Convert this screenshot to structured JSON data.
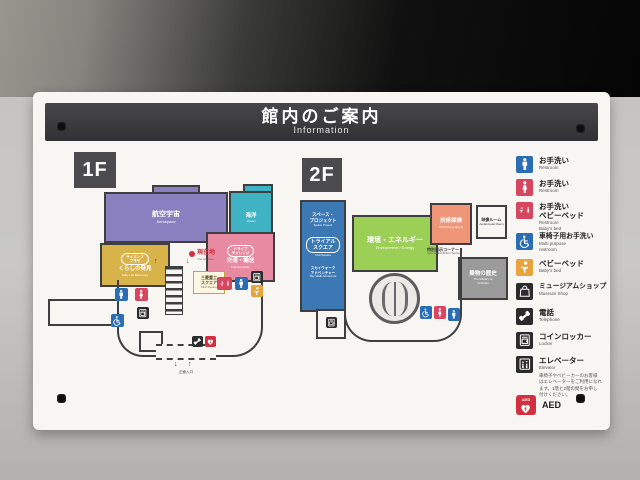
{
  "header": {
    "title_jp": "館内のご案内",
    "title_en": "Information"
  },
  "floor1": {
    "label": "1F",
    "rooms": {
      "aerospace": {
        "jp": "航空宇宙",
        "en": "Aerospace"
      },
      "ocean": {
        "jp": "海洋",
        "en": "Ocean"
      },
      "daily": {
        "badge1": "サイエンス",
        "badge2": "プラザ",
        "jp": "くらしの発見",
        "en": "Daily Life Discovery"
      },
      "transport": {
        "badge1": "ドライブ",
        "badge2": "チャレンジ",
        "jp": "交通・輸送",
        "en": "Transportation"
      }
    },
    "marker_jp": "現在地",
    "marker_en": "You are here",
    "mhi1": "三菱重工",
    "mhi2": "スクエア",
    "mhi_en": "MHI Square",
    "entrance": "正面入口",
    "arrow_down": "↓",
    "arrow_up": "↑",
    "stair_up": "↑",
    "stair_down": "↓"
  },
  "floor2": {
    "label": "2F",
    "rooms": {
      "space": {
        "jp1": "スペース・",
        "jp2": "プロジェクト",
        "en": "Space Project"
      },
      "trial": {
        "b1": "トライアル",
        "b2": "スクエア",
        "en": "Trial Square"
      },
      "skywalk": {
        "jp1": "スカイウォーク",
        "jp2": "アドベンチャー",
        "en": "Sky Walk Adventure"
      },
      "environment": {
        "jp": "環境・エネルギー",
        "en": "Environment / Energy"
      },
      "technology": {
        "jp": "技術探検",
        "en": "Technology Quest"
      },
      "av_room": {
        "jp": "映像ルーム",
        "en": "Audiovisual Room"
      },
      "special": {
        "jp": "特別展示コーナー",
        "en": "Special Exhibition Section"
      },
      "history": {
        "jp": "乗物の歴史",
        "en1": "The History of",
        "en2": "Vehicles"
      }
    }
  },
  "legend": {
    "items": [
      {
        "jp": "お手洗い",
        "en": "Restroom"
      },
      {
        "jp": "お手洗い",
        "en": "Restroom"
      },
      {
        "jp": "お手洗い",
        "jp2": "ベビーベッド",
        "en": "Restroom",
        "en2": "Baby's bed"
      },
      {
        "jp": "車椅子用お手洗い",
        "en": "Multi purpose",
        "en2": "restroom"
      },
      {
        "jp": "ベビーベッド",
        "en": "Baby's bed"
      },
      {
        "jp": "ミュージアムショップ",
        "en": "Museum Shop"
      },
      {
        "jp": "電話",
        "en": "Telephone"
      },
      {
        "jp": "コインロッカー",
        "en": "Locker"
      },
      {
        "jp": "エレベーター",
        "en": "Elevator",
        "note1": "車椅子やベビーカーのお客様",
        "note2": "はエレベーターをご利用になれ",
        "note3": "ます。1階と2階の間をお申し",
        "note4": "付けください。"
      },
      {
        "jp": "AED"
      }
    ]
  },
  "colors": {
    "accent_blue": "#2a6db5",
    "accent_red": "#d6465f",
    "accent_orange": "#e8a33d",
    "accent_black": "#2b2b2b",
    "aed_red": "#d3303f",
    "room_purple": "#8a80bf",
    "room_teal": "#3fb3c4",
    "room_yellow": "#d7b34a",
    "room_pink": "#e88aa2",
    "room_blue": "#3c78b3",
    "room_green": "#9ccf55",
    "room_salmon": "#ef9678",
    "room_gray": "#9b9b9b",
    "titlebar": "#3a3a3c"
  }
}
